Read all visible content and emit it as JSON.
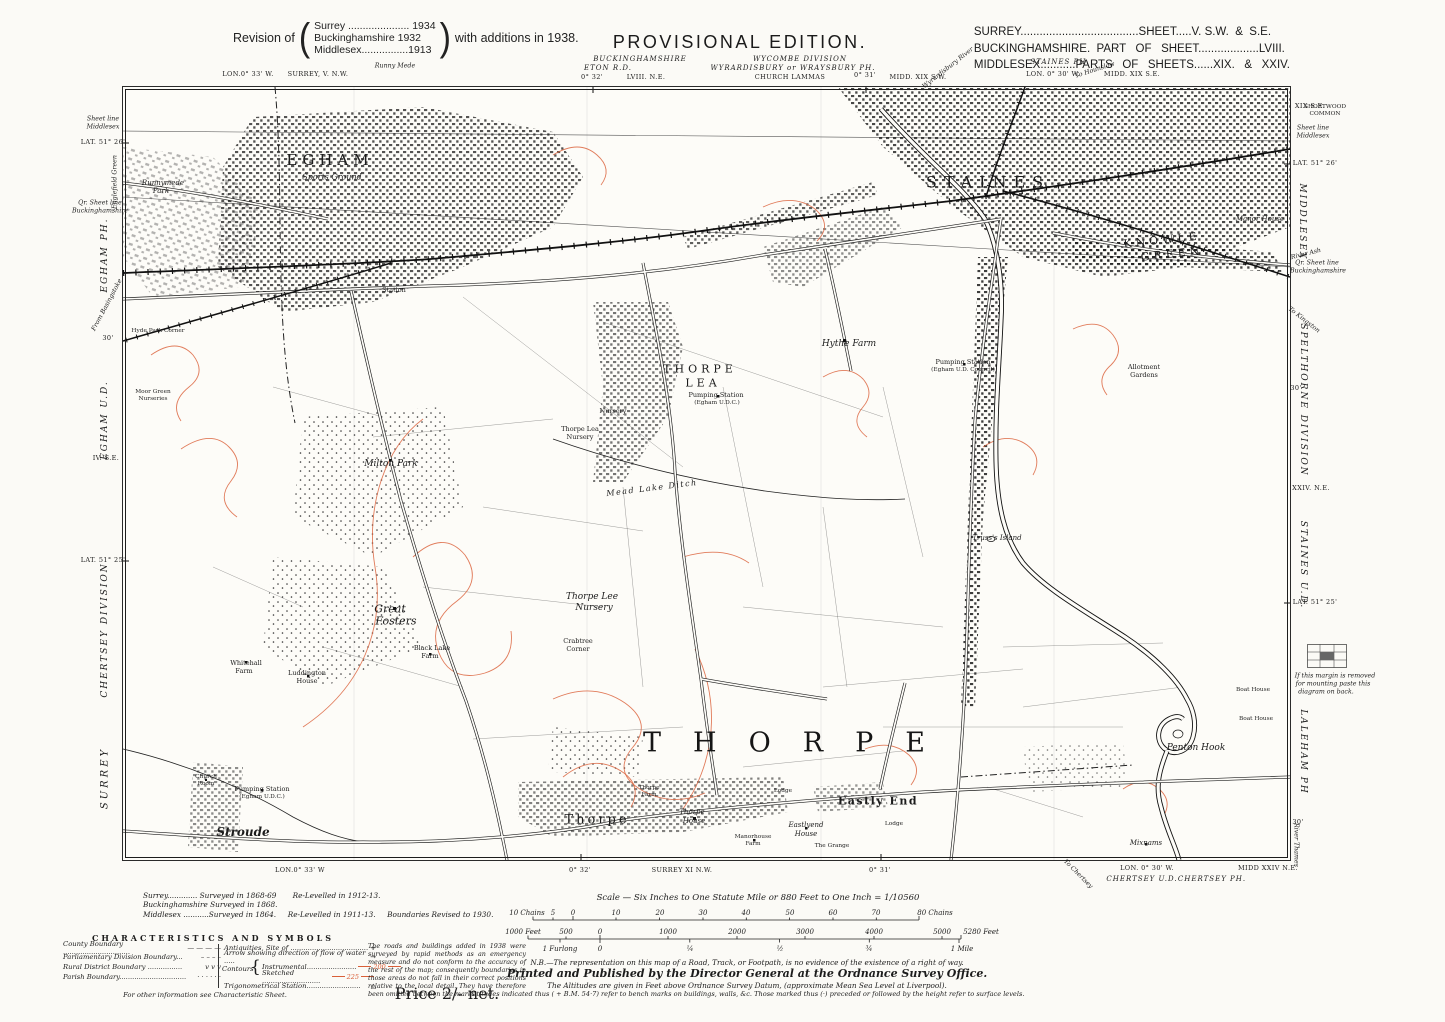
{
  "header": {
    "revision_prefix": "Revision of",
    "revision_lines": [
      "Surrey ..................... 1934",
      "Buckinghamshire  1932",
      "Middlesex................1913"
    ],
    "revision_suffix": "with additions in 1938.",
    "title": "PROVISIONAL EDITION.",
    "sheet_lines": [
      "SURREY.....................................SHEET.....V. S.W.  &  S.E.",
      "BUCKINGHAMSHIRE.  PART   OF   SHEET...................LVIII.",
      "MIDDLESEX...........PARTS   OF   SHEETS......XIX.   &   XXIV."
    ]
  },
  "footer": {
    "survey_lines": [
      "Surrey............. Surveyed in 1868-69       Re-Levelled in 1912-13.",
      "Buckinghamshire Surveyed in 1868.",
      "Middlesex ...........Surveyed in 1864.     Re-Levelled in 1911-13.     Boundaries Revised to 1930."
    ],
    "characteristics": {
      "title": "CHARACTERISTICS  AND  SYMBOLS",
      "left": [
        {
          "label": "County Boundary ...............................",
          "sym": "dash-lg"
        },
        {
          "label": "Parliamentary Division Boundary...",
          "sym": "dash-md"
        },
        {
          "label": "Rural District Boundary ................",
          "sym": "vvv"
        },
        {
          "label": "Parish Boundary...............................",
          "sym": "dots"
        }
      ],
      "mid": [
        {
          "label": "Antiquities, Site of ....................................",
          "sym": "cross",
          "ind": false
        },
        {
          "label": "Arrow showing direction of flow of water .....",
          "sym": "arrow",
          "ind": false
        },
        {
          "label": "Instrumental.......................",
          "sym": "c200",
          "ind": true
        },
        {
          "label": "Sketched ...........................",
          "sym": "c225",
          "ind": true
        },
        {
          "label": "Trigonometrical Station.........................",
          "sym": "triangle",
          "ind": false
        }
      ],
      "contours_label": "Contours",
      "note": "For other information see Characteristic Sheet.",
      "paragraph": "The roads and buildings added in 1938 were surveyed by rapid methods as an emergency measure and do not conform to the accuracy of the rest of the map; consequently boundaries in those areas do not fall in their correct positions relative to the local detail.  They have therefore been omitted between the marks."
    },
    "scale_title": "Scale — Six Inches to One Statute Mile or 880 Feet to One Inch = 1/10560",
    "nb": "N.B.—The representation on this map of a Road, Track, or Footpath, is no evidence of the existence of a right of way.",
    "printed": "Printed and Published by the Director General at the Ordnance Survey Office.",
    "altitude1": "The Altitudes are given in Feet above Ordnance Survey Datum, (approximate Mean Sea Level at Liverpool).",
    "altitude2": "Altitudes indicated thus ( + B.M. 54·7) refer to bench marks on buildings, walls, &c.      Those marked thus (·) preceded or followed by the height  refer to surface levels.",
    "price": "Price 2/- net."
  },
  "colors": {
    "contour": "#dc6540",
    "ink": "#1c1c1c",
    "paper": "#fbfaf6"
  },
  "annotations": [
    {
      "t": "Runny Mede",
      "x": 395,
      "y": 66,
      "c": "geo-i"
    },
    {
      "t": "LON.0° 33' W.",
      "x": 248,
      "y": 74,
      "c": "geo"
    },
    {
      "t": "SURREY, V. N.W.",
      "x": 318,
      "y": 74,
      "c": "geo"
    },
    {
      "t": "BUCKINGHAMSHIRE",
      "x": 640,
      "y": 59,
      "c": "county-it"
    },
    {
      "t": "WYCOMBE DIVISION",
      "x": 800,
      "y": 59,
      "c": "county-it"
    },
    {
      "t": "ETON R.D.",
      "x": 608,
      "y": 68,
      "c": "county-it"
    },
    {
      "t": "WYRARDISBURY or WRAYSBURY PH.",
      "x": 793,
      "y": 68,
      "c": "county-it"
    },
    {
      "t": "0° 32'",
      "x": 592,
      "y": 77,
      "c": "geo"
    },
    {
      "t": "LVIII. N.E.",
      "x": 646,
      "y": 77,
      "c": "geo"
    },
    {
      "t": "CHURCH LAMMAS",
      "x": 790,
      "y": 77,
      "c": "geo"
    },
    {
      "t": "0° 31'",
      "x": 865,
      "y": 75,
      "c": "geo"
    },
    {
      "t": "MIDD. XIX S.W.",
      "x": 918,
      "y": 77,
      "c": "geo"
    },
    {
      "t": "Wyrardisbury River",
      "x": 948,
      "y": 68,
      "c": "geo-i",
      "r": -38
    },
    {
      "t": "STAINES PH.",
      "x": 1060,
      "y": 62,
      "c": "county-it"
    },
    {
      "t": "LON. 0° 30' W.",
      "x": 1053,
      "y": 74,
      "c": "geo"
    },
    {
      "t": "To Hounslow",
      "x": 1095,
      "y": 70,
      "c": "geo-i",
      "r": -18
    },
    {
      "t": "MIDD. XIX S.E.",
      "x": 1132,
      "y": 74,
      "c": "geo"
    },
    {
      "t": "Sheet line",
      "x": 103,
      "y": 119,
      "c": "geo-i"
    },
    {
      "t": "Middlesex",
      "x": 103,
      "y": 127,
      "c": "geo-i"
    },
    {
      "t": "LAT. 51° 26'",
      "x": 103,
      "y": 142,
      "c": "geo"
    },
    {
      "t": "Englefield Green",
      "x": 115,
      "y": 182,
      "c": "geo-i",
      "r": -90
    },
    {
      "t": "Qr. Sheet line",
      "x": 100,
      "y": 203,
      "c": "geo-i"
    },
    {
      "t": "Buckinghamshire",
      "x": 100,
      "y": 211,
      "c": "geo-i"
    },
    {
      "t": "EGHAM PH.",
      "x": 105,
      "y": 255,
      "c": "marg",
      "r": -90
    },
    {
      "t": "From Basingstoke",
      "x": 107,
      "y": 305,
      "c": "geo-i",
      "r": -62
    },
    {
      "t": "30'",
      "x": 108,
      "y": 338,
      "c": "geo"
    },
    {
      "t": "EGHAM U.D.",
      "x": 105,
      "y": 420,
      "c": "marg",
      "r": -90
    },
    {
      "t": "IV. S.E.",
      "x": 106,
      "y": 458,
      "c": "geo"
    },
    {
      "t": "LAT. 51° 25'",
      "x": 103,
      "y": 560,
      "c": "geo"
    },
    {
      "t": "CHERTSEY DIVISION",
      "x": 105,
      "y": 630,
      "c": "marg",
      "r": -90
    },
    {
      "t": "SURREY",
      "x": 105,
      "y": 778,
      "c": "marg-lg",
      "r": -90
    },
    {
      "t": "XIX S.E.",
      "x": 1310,
      "y": 106,
      "c": "geo"
    },
    {
      "t": "Sheet line",
      "x": 1313,
      "y": 128,
      "c": "geo-i"
    },
    {
      "t": "Middlesex",
      "x": 1313,
      "y": 136,
      "c": "geo-i"
    },
    {
      "t": "LAT. 51° 26'",
      "x": 1315,
      "y": 163,
      "c": "geo"
    },
    {
      "t": "MIDDLESEX",
      "x": 1302,
      "y": 222,
      "c": "marg",
      "r": 90
    },
    {
      "t": "River Ash",
      "x": 1306,
      "y": 254,
      "c": "geo-i",
      "r": -14
    },
    {
      "t": "Qr. Sheet line",
      "x": 1317,
      "y": 263,
      "c": "geo-i"
    },
    {
      "t": "Buckinghamshire",
      "x": 1318,
      "y": 271,
      "c": "geo-i"
    },
    {
      "t": "To Kingston",
      "x": 1304,
      "y": 320,
      "c": "geo-i",
      "r": 38
    },
    {
      "t": "30'",
      "x": 1296,
      "y": 388,
      "c": "geo"
    },
    {
      "t": "SPELTHORNE DIVISION",
      "x": 1303,
      "y": 400,
      "c": "marg",
      "r": 90
    },
    {
      "t": "XXIV. N.E.",
      "x": 1311,
      "y": 488,
      "c": "geo"
    },
    {
      "t": "STAINES U.D.",
      "x": 1303,
      "y": 565,
      "c": "marg",
      "r": 90
    },
    {
      "t": "LAT. 51° 25'",
      "x": 1315,
      "y": 602,
      "c": "geo"
    },
    {
      "t": "If this margin is removed",
      "x": 1335,
      "y": 676,
      "c": "geo-i"
    },
    {
      "t": "for mounting paste this",
      "x": 1333,
      "y": 684,
      "c": "geo-i"
    },
    {
      "t": "diagram on back.",
      "x": 1326,
      "y": 692,
      "c": "geo-i"
    },
    {
      "t": "LALEHAM PH",
      "x": 1303,
      "y": 752,
      "c": "marg",
      "r": 90
    },
    {
      "t": "30'",
      "x": 1298,
      "y": 822,
      "c": "geo"
    },
    {
      "t": "River Thames",
      "x": 1296,
      "y": 845,
      "c": "geo-i",
      "r": 90
    },
    {
      "t": "LON.0° 33' W",
      "x": 300,
      "y": 870,
      "c": "geo"
    },
    {
      "t": "0° 32'",
      "x": 580,
      "y": 870,
      "c": "geo"
    },
    {
      "t": "SURREY XI N.W.",
      "x": 682,
      "y": 870,
      "c": "geo"
    },
    {
      "t": "0° 31'",
      "x": 880,
      "y": 870,
      "c": "geo"
    },
    {
      "t": "To Chertsey",
      "x": 1078,
      "y": 874,
      "c": "geo-i",
      "r": 45
    },
    {
      "t": "LON. 0° 30' W.",
      "x": 1147,
      "y": 868,
      "c": "geo"
    },
    {
      "t": "CHERTSEY U.D.",
      "x": 1142,
      "y": 879,
      "c": "county-it"
    },
    {
      "t": "CHERTSEY PH.",
      "x": 1212,
      "y": 879,
      "c": "county-it"
    },
    {
      "t": "MIDD XXIV N.E.",
      "x": 1268,
      "y": 868,
      "c": "geo"
    },
    {
      "t": "EGHAM",
      "x": 330,
      "y": 160,
      "c": "town"
    },
    {
      "t": "Sports Ground",
      "x": 332,
      "y": 177,
      "c": "si"
    },
    {
      "t": "Station",
      "x": 394,
      "y": 290,
      "c": "t6"
    },
    {
      "t": "STAINES",
      "x": 988,
      "y": 182,
      "c": "town-lg"
    },
    {
      "t": "KNOWLE",
      "x": 1162,
      "y": 240,
      "c": "grn",
      "r": -6
    },
    {
      "t": "GREEN",
      "x": 1172,
      "y": 254,
      "c": "grn",
      "r": -6
    },
    {
      "t": "Manor House",
      "x": 1260,
      "y": 219,
      "c": "ti"
    },
    {
      "t": "SHORTWOOD",
      "x": 1325,
      "y": 107,
      "c": "m5"
    },
    {
      "t": "COMMON",
      "x": 1325,
      "y": 114,
      "c": "m5"
    },
    {
      "t": "THORPE",
      "x": 700,
      "y": 369,
      "c": "ham"
    },
    {
      "t": "LEA",
      "x": 703,
      "y": 383,
      "c": "ham"
    },
    {
      "t": "Hythe Farm",
      "x": 849,
      "y": 344,
      "c": "fi"
    },
    {
      "t": "Pumping Station",
      "x": 716,
      "y": 395,
      "c": "t6"
    },
    {
      "t": "(Egham U.D.C.)",
      "x": 717,
      "y": 403,
      "c": "m5"
    },
    {
      "t": "Pumping Station",
      "x": 963,
      "y": 362,
      "c": "t6"
    },
    {
      "t": "(Egham U.D. Council)",
      "x": 963,
      "y": 370,
      "c": "m5"
    },
    {
      "t": "Nursery",
      "x": 613,
      "y": 411,
      "c": "t6"
    },
    {
      "t": "Thorpe Lea",
      "x": 580,
      "y": 429,
      "c": "t6"
    },
    {
      "t": "Nursery",
      "x": 580,
      "y": 437,
      "c": "t6"
    },
    {
      "t": "Milton Park",
      "x": 391,
      "y": 464,
      "c": "fi"
    },
    {
      "t": "Thorpe Lee",
      "x": 592,
      "y": 597,
      "c": "fi"
    },
    {
      "t": "Nursery",
      "x": 594,
      "y": 608,
      "c": "fi"
    },
    {
      "t": "Great",
      "x": 390,
      "y": 609,
      "c": "fl"
    },
    {
      "t": "Fosters",
      "x": 396,
      "y": 621,
      "c": "fl"
    },
    {
      "t": "Black Lake",
      "x": 432,
      "y": 648,
      "c": "t6"
    },
    {
      "t": "Farm",
      "x": 430,
      "y": 656,
      "c": "t6"
    },
    {
      "t": "Crabtree",
      "x": 578,
      "y": 641,
      "c": "t6"
    },
    {
      "t": "Corner",
      "x": 578,
      "y": 649,
      "c": "t6"
    },
    {
      "t": "Whitehall",
      "x": 246,
      "y": 663,
      "c": "t6"
    },
    {
      "t": "Farm",
      "x": 244,
      "y": 671,
      "c": "t6"
    },
    {
      "t": "Luddington",
      "x": 307,
      "y": 673,
      "c": "t6"
    },
    {
      "t": "House",
      "x": 307,
      "y": 681,
      "c": "t6"
    },
    {
      "t": "Mead Lake Ditch",
      "x": 652,
      "y": 488,
      "c": "wi",
      "r": -7
    },
    {
      "t": "THORPE",
      "x": 800,
      "y": 743,
      "c": "huge"
    },
    {
      "t": "Stroude",
      "x": 243,
      "y": 832,
      "c": "vi"
    },
    {
      "t": "Thorpe",
      "x": 597,
      "y": 820,
      "c": "vil"
    },
    {
      "t": "Thorpe",
      "x": 649,
      "y": 788,
      "c": "m5"
    },
    {
      "t": "Farm",
      "x": 649,
      "y": 795,
      "c": "m5"
    },
    {
      "t": "Thorpe",
      "x": 692,
      "y": 812,
      "c": "ti"
    },
    {
      "t": "House",
      "x": 694,
      "y": 821,
      "c": "ti"
    },
    {
      "t": "Manorhouse",
      "x": 753,
      "y": 837,
      "c": "m5"
    },
    {
      "t": "Farm",
      "x": 753,
      "y": 844,
      "c": "m5"
    },
    {
      "t": "Eastly  End",
      "x": 878,
      "y": 801,
      "c": "vsm"
    },
    {
      "t": "Eastlyend",
      "x": 806,
      "y": 825,
      "c": "ti"
    },
    {
      "t": "House",
      "x": 806,
      "y": 834,
      "c": "ti"
    },
    {
      "t": "The Grange",
      "x": 832,
      "y": 846,
      "c": "m5"
    },
    {
      "t": "Lodge",
      "x": 783,
      "y": 791,
      "c": "m5"
    },
    {
      "t": "Lodge",
      "x": 894,
      "y": 824,
      "c": "m5"
    },
    {
      "t": "Penton Hook",
      "x": 1196,
      "y": 748,
      "c": "fi"
    },
    {
      "t": "Mixnams",
      "x": 1146,
      "y": 843,
      "c": "ti"
    },
    {
      "t": "Runnymede",
      "x": 163,
      "y": 183,
      "c": "ti"
    },
    {
      "t": "Park",
      "x": 161,
      "y": 191,
      "c": "ti"
    },
    {
      "t": "Hyde Park Corner",
      "x": 158,
      "y": 331,
      "c": "m5"
    },
    {
      "t": "Moor Green",
      "x": 153,
      "y": 392,
      "c": "m5"
    },
    {
      "t": "Nurseries",
      "x": 153,
      "y": 399,
      "c": "m5"
    },
    {
      "t": "Pumping Station",
      "x": 262,
      "y": 789,
      "c": "t6"
    },
    {
      "t": "(Egham U.D.C.)",
      "x": 262,
      "y": 797,
      "c": "m5"
    },
    {
      "t": "Church",
      "x": 206,
      "y": 777,
      "c": "m5"
    },
    {
      "t": "Room",
      "x": 206,
      "y": 784,
      "c": "m5"
    },
    {
      "t": "Truss's Island",
      "x": 997,
      "y": 538,
      "c": "ti"
    },
    {
      "t": "Allotment",
      "x": 1144,
      "y": 367,
      "c": "t6"
    },
    {
      "t": "Gardens",
      "x": 1144,
      "y": 375,
      "c": "t6"
    },
    {
      "t": "Boat House",
      "x": 1253,
      "y": 690,
      "c": "m5"
    },
    {
      "t": "Boat House",
      "x": 1256,
      "y": 719,
      "c": "m5"
    },
    {
      "t": "10 Chains",
      "x": 527,
      "y": 913,
      "c": "scl"
    },
    {
      "t": "5",
      "x": 553,
      "y": 913,
      "c": "scl"
    },
    {
      "t": "0",
      "x": 573,
      "y": 913,
      "c": "scl"
    },
    {
      "t": "10",
      "x": 616,
      "y": 913,
      "c": "scl"
    },
    {
      "t": "20",
      "x": 660,
      "y": 913,
      "c": "scl"
    },
    {
      "t": "30",
      "x": 703,
      "y": 913,
      "c": "scl"
    },
    {
      "t": "40",
      "x": 746,
      "y": 913,
      "c": "scl"
    },
    {
      "t": "50",
      "x": 790,
      "y": 913,
      "c": "scl"
    },
    {
      "t": "60",
      "x": 833,
      "y": 913,
      "c": "scl"
    },
    {
      "t": "70",
      "x": 876,
      "y": 913,
      "c": "scl"
    },
    {
      "t": "80 Chains",
      "x": 935,
      "y": 913,
      "c": "scl"
    },
    {
      "t": "1000 Feet",
      "x": 523,
      "y": 932,
      "c": "scl"
    },
    {
      "t": "500",
      "x": 566,
      "y": 932,
      "c": "scl"
    },
    {
      "t": "0",
      "x": 600,
      "y": 932,
      "c": "scl"
    },
    {
      "t": "1000",
      "x": 668,
      "y": 932,
      "c": "scl"
    },
    {
      "t": "2000",
      "x": 737,
      "y": 932,
      "c": "scl"
    },
    {
      "t": "3000",
      "x": 805,
      "y": 932,
      "c": "scl"
    },
    {
      "t": "4000",
      "x": 874,
      "y": 932,
      "c": "scl"
    },
    {
      "t": "5000",
      "x": 942,
      "y": 932,
      "c": "scl"
    },
    {
      "t": "5280 Feet",
      "x": 981,
      "y": 932,
      "c": "scl"
    },
    {
      "t": "1 Furlong",
      "x": 560,
      "y": 949,
      "c": "scl"
    },
    {
      "t": "0",
      "x": 600,
      "y": 949,
      "c": "scl"
    },
    {
      "t": "¼",
      "x": 690,
      "y": 949,
      "c": "scl"
    },
    {
      "t": "½",
      "x": 780,
      "y": 949,
      "c": "scl"
    },
    {
      "t": "¾",
      "x": 869,
      "y": 949,
      "c": "scl"
    },
    {
      "t": "1 Mile",
      "x": 962,
      "y": 949,
      "c": "scl"
    }
  ]
}
